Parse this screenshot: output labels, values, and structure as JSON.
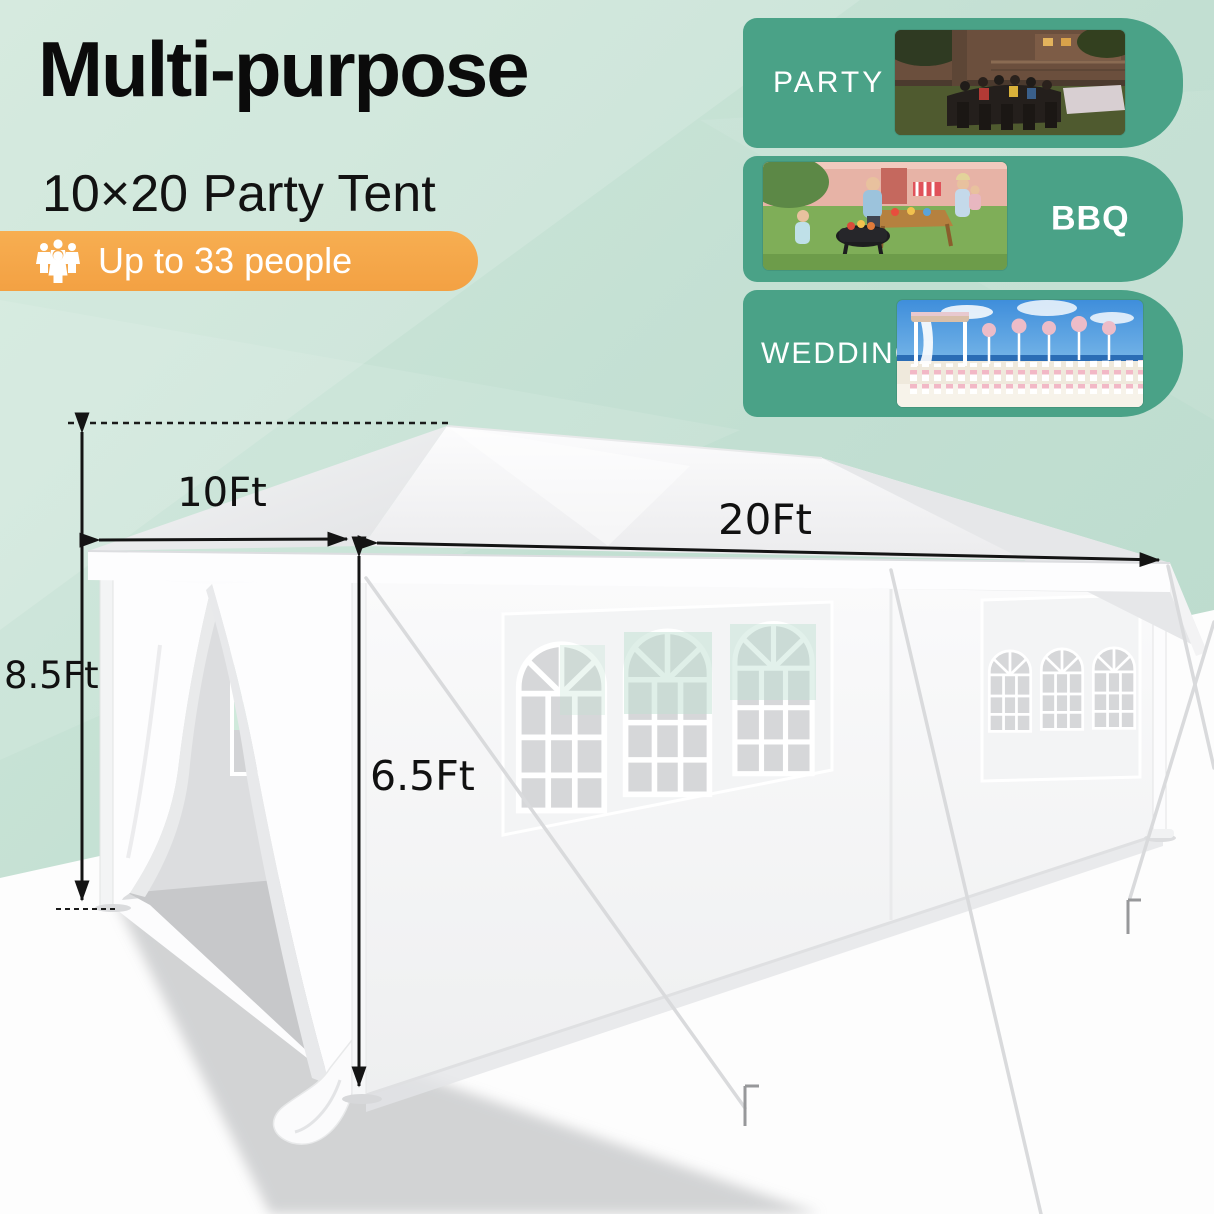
{
  "title": "Multi-purpose",
  "subtitle": "10×20 Party Tent",
  "badge": {
    "label": "Up to 33 people"
  },
  "use_cases": [
    {
      "label": "PARTY"
    },
    {
      "label": "BBQ"
    },
    {
      "label": "WEDDING"
    }
  ],
  "dimensions": {
    "front_width": "10Ft",
    "length": "20Ft",
    "peak_height": "8.5Ft",
    "eave_height": "6.5Ft"
  },
  "colors": {
    "background": "#c5e1d5",
    "card_green": "#4aa287",
    "badge_orange": "#f5a84a",
    "text": "#0b0b0b",
    "tent_white": "#fbfbfc"
  }
}
